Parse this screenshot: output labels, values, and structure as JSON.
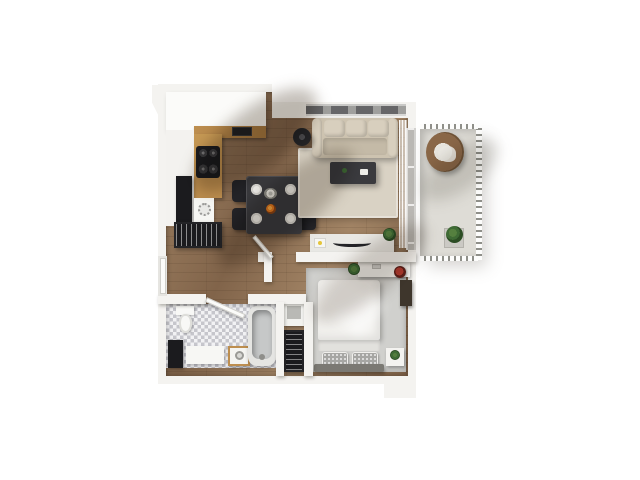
{
  "scene": {
    "description": "Top-down 3D rendered floor plan of a one-bedroom apartment with open kitchen/living area, bedroom, bathroom, hallway and a balcony with railing on the right side",
    "background": "#ffffff",
    "palette": {
      "wall": "#f4f3f0",
      "wood_a": "#a28465",
      "wood_b": "#81644a",
      "counter_wood": "#bd8e4f",
      "tile_a": "#f2f2f4",
      "tile_b": "#c6c6cc",
      "balcony": "#dedcd6",
      "railing": "#8f8f89",
      "carpet": "#d0d0cd",
      "rug": "#d9d2c4",
      "sofa": "#cdc3b0",
      "sofa_light": "#d8cfbe",
      "dark": "#3a3a3e",
      "black": "#1b1b1e",
      "fruit": "#e0791f",
      "green": "#3f6b35",
      "rattan": "#8a6747",
      "red": "#b03a2e",
      "window": "#9f9f9d",
      "window_dark": "#666668",
      "metal": "#c6c8c8",
      "pillow": "#a6a6a3"
    },
    "rooms": [
      {
        "name": "kitchen",
        "furniture": [
          "upper-cabinet-block",
          "wood-countertop-l-shape",
          "sink",
          "cooktop-4-burners",
          "tall-black-fridge",
          "cabinet-with-fan",
          "bottle-rack"
        ]
      },
      {
        "name": "dining-area",
        "furniture": [
          "dark-dining-table",
          "four-black-chairs",
          "four-plates",
          "flower-vase",
          "orange-fruit-bowl"
        ]
      },
      {
        "name": "living-room",
        "furniture": [
          "beige-three-seat-sofa",
          "area-rug",
          "dark-coffee-table",
          "black-floor-lamp",
          "tv-sideboard",
          "tv",
          "decor-box",
          "potted-plant",
          "sheer-curtain",
          "window-band"
        ]
      },
      {
        "name": "bedroom",
        "furniture": [
          "double-bed-white-duvet",
          "two-patterned-pillows",
          "headboard",
          "gray-carpet",
          "nightstand-with-plant",
          "desk",
          "red-desk-chair",
          "desk-plant",
          "dark-dresser"
        ]
      },
      {
        "name": "bathroom",
        "furniture": [
          "patterned-tile-floor",
          "toilet",
          "black-cabinet",
          "vanity-with-sink",
          "washing-machine",
          "bathtub"
        ]
      },
      {
        "name": "hallway",
        "furniture": [
          "entry-door",
          "open-bathroom-door",
          "open-bedroom-door",
          "niche-washer",
          "niche-bottle-rack"
        ]
      },
      {
        "name": "balcony",
        "furniture": [
          "hanging-rattan-chair",
          "potted-plant",
          "slatted-railing"
        ]
      }
    ]
  }
}
